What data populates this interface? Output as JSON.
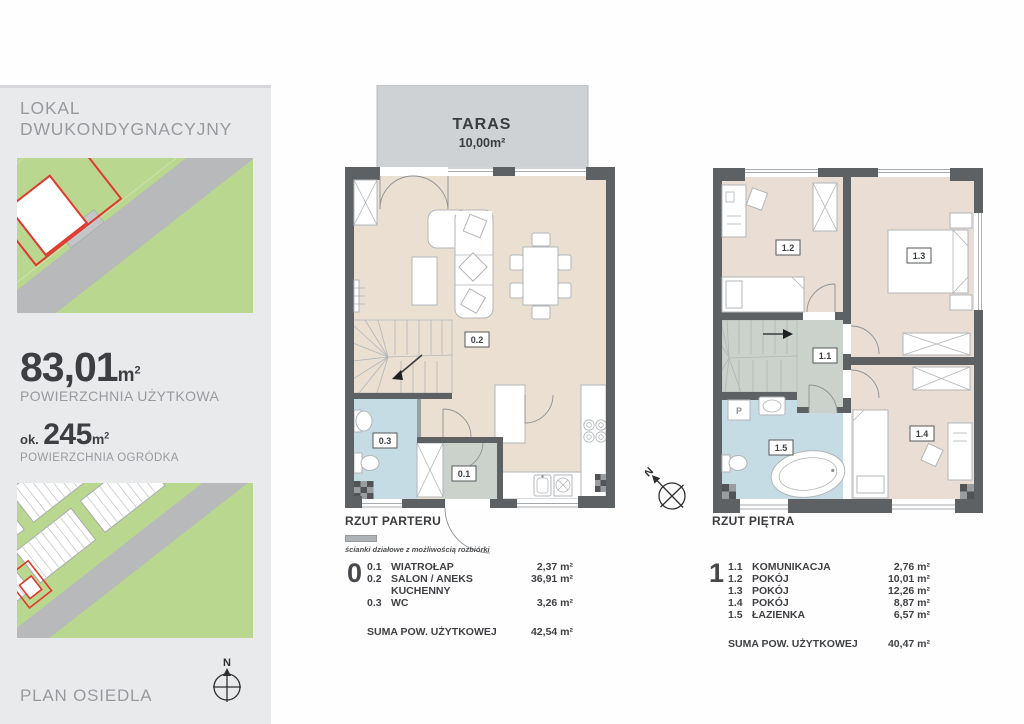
{
  "sidebar": {
    "title": "LOKAL DWUKONDYGNACYJNY",
    "usable_area": {
      "value": "83,01",
      "unit_base": "m",
      "unit_exp": "2",
      "label": "POWIERZCHNIA UŻYTKOWA"
    },
    "garden_area": {
      "prefix": "ok.",
      "value": "245",
      "unit_base": "m",
      "unit_exp": "2",
      "label": "POWIERZCHNIA OGRÓDKA"
    },
    "plan_label": "PLAN OSIEDLA",
    "compass_n": "N"
  },
  "ground_floor": {
    "terrace_title": "TARAS",
    "terrace_area": "10,00m²",
    "caption": "RZUT PARTERU",
    "legend_text": "ścianki działowe z możliwością rozbiórki",
    "level": "0",
    "labels": {
      "l01": "0.1",
      "l02": "0.2",
      "l03": "0.3"
    },
    "rooms": [
      {
        "no": "0.1",
        "name": "WIATROŁAP",
        "area": "2,37 m²"
      },
      {
        "no": "0.2",
        "name": "SALON / ANEKS KUCHENNY",
        "area": "36,91 m²"
      },
      {
        "no": "0.3",
        "name": "WC",
        "area": "3,26 m²"
      }
    ],
    "sum_label": "SUMA POW. UŻYTKOWEJ",
    "sum_area": "42,54 m²"
  },
  "upper_floor": {
    "caption": "RZUT PIĘTRA",
    "level": "1",
    "compass_n": "N",
    "labels": {
      "l11": "1.1",
      "l12": "1.2",
      "l13": "1.3",
      "l14": "1.4",
      "l15": "1.5",
      "washer": "P"
    },
    "rooms": [
      {
        "no": "1.1",
        "name": "KOMUNIKACJA",
        "area": "2,76 m²"
      },
      {
        "no": "1.2",
        "name": "POKÓJ",
        "area": "10,01 m²"
      },
      {
        "no": "1.3",
        "name": "POKÓJ",
        "area": "12,26 m²"
      },
      {
        "no": "1.4",
        "name": "POKÓJ",
        "area": "8,87 m²"
      },
      {
        "no": "1.5",
        "name": "ŁAZIENKA",
        "area": "6,57 m²"
      }
    ],
    "sum_label": "SUMA POW. UŻYTKOWEJ",
    "sum_area": "40,47 m²"
  },
  "colors": {
    "wall": "#5e6163",
    "floor": "#ebdfd2",
    "bedroom": "#e9ddd4",
    "bath": "#c6dce4",
    "hall": "#cbd1cb",
    "terrace": "#ced2d4",
    "panel": "#e9eaec",
    "green": "#b9d78e",
    "red": "#e0392e",
    "text_dark": "#3c3e42",
    "text_gray": "#989a9e",
    "line": "#b2b5b7"
  }
}
